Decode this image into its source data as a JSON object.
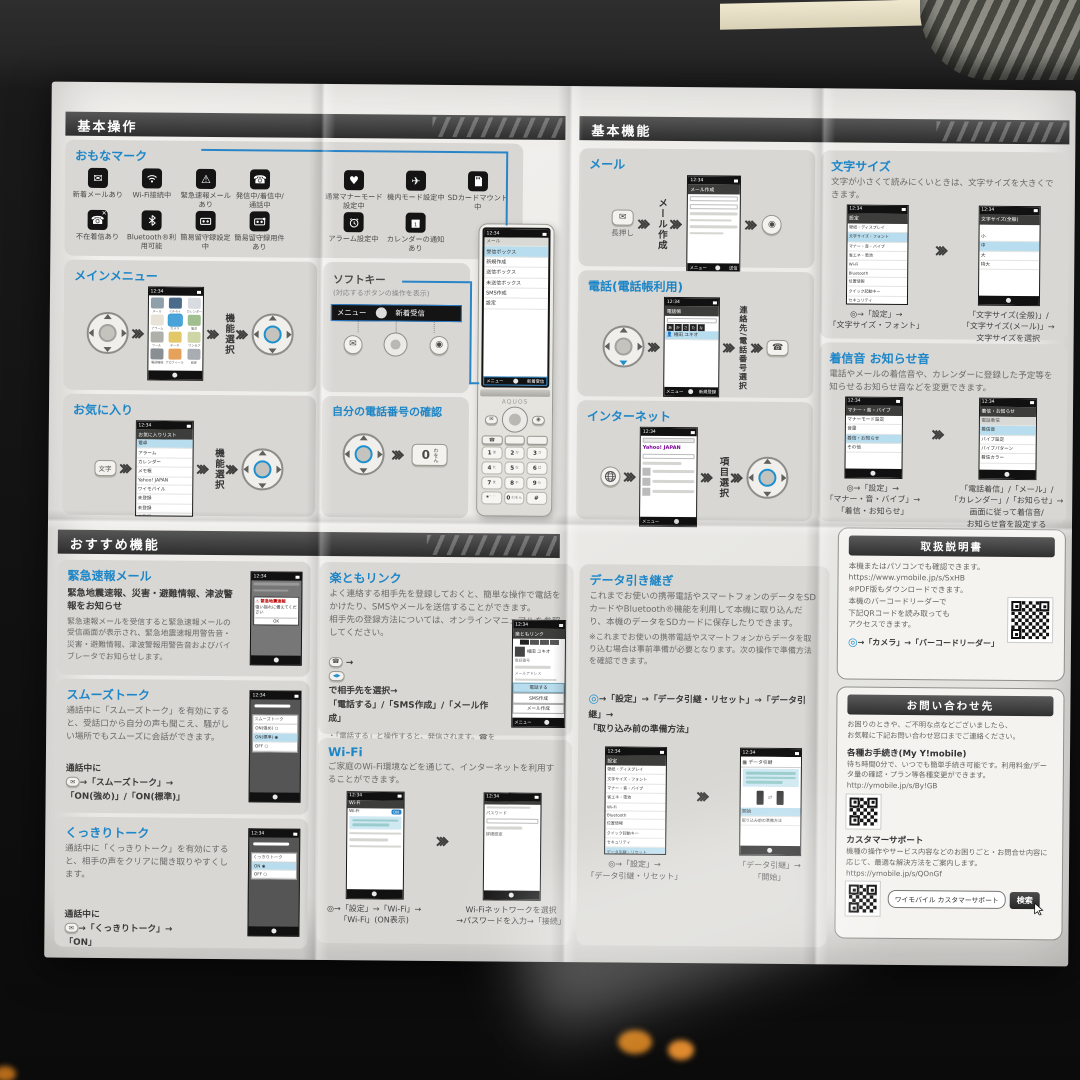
{
  "headers": {
    "h1": "基本操作",
    "h2": "基本機能",
    "h3": "おすすめ機能"
  },
  "status_time": "12:34",
  "marks": {
    "title": "おもなマーク",
    "r1": [
      "新着メールあり",
      "Wi-Fi接続中",
      "緊急速報メールあり",
      "発信中/着信中/通話中",
      "通常マナーモード設定中",
      "機内モード設定中",
      "SDカードマウント中"
    ],
    "r2": [
      "不在着信あり",
      "Bluetooth®利用可能",
      "簡易留守録設定中",
      "簡易留守録用件あり",
      "アラーム設定中",
      "カレンダーの通知あり"
    ]
  },
  "mainmenu": {
    "title": "メインメニュー",
    "step": "機能選択",
    "apps": [
      "メール",
      "ｲﾝﾀｰﾈｯﾄ",
      "カレンダー",
      "アラーム",
      "カメラ",
      "電卓",
      "ツール",
      "データ",
      "ワンセグ",
      "電話機能",
      "プロフィール",
      "設定"
    ]
  },
  "softkey": {
    "title": "ソフトキー",
    "note": "(対応するボタンの操作を表示)",
    "menu": "メニュー",
    "center": "●",
    "right": "新着受信"
  },
  "favorites": {
    "title": "お気に入り",
    "key": "文字",
    "step": "機能選択",
    "screen_title": "お気に入りリスト",
    "list": [
      "電卓",
      "アラーム",
      "カレンダー",
      "メモ帳",
      "Yahoo! JAPAN",
      "ワイモバイル",
      "未登録",
      "未登録",
      "未登録"
    ]
  },
  "mynumber": {
    "title": "自分の電話番号の確認",
    "key_main": "0",
    "key_sub": "わをん"
  },
  "phone": {
    "brand": "AQUOS",
    "screen_title": "メール",
    "menu": [
      "受信ボックス",
      "新規作成",
      "送信ボックス",
      "未送信ボックス",
      "SMS作成",
      "設定"
    ],
    "soft_l": "メニュー",
    "soft_c": "●",
    "soft_r": "新着受信",
    "keys": [
      [
        "1",
        "あ"
      ],
      [
        "2",
        "か"
      ],
      [
        "3",
        "さ"
      ],
      [
        "4",
        "た"
      ],
      [
        "5",
        "な"
      ],
      [
        "6",
        "は"
      ],
      [
        "7",
        "ま"
      ],
      [
        "8",
        "や"
      ],
      [
        "9",
        "ら"
      ],
      [
        "*",
        "゛゜"
      ],
      [
        "0",
        "わをん"
      ],
      [
        "#",
        ""
      ]
    ]
  },
  "mail": {
    "title": "メール",
    "press": "長押し",
    "step": "メール作成",
    "screen_title": "メール作成",
    "soft": "送信"
  },
  "tel": {
    "title": "電話(電話帳利用)",
    "step": "連絡先/電話番号選択",
    "screen_title": "電話帳",
    "tabs": [
      "あ",
      "か",
      "さ",
      "た",
      "な"
    ],
    "entry": "相田 ユキオ",
    "soft_r": "新規登録"
  },
  "inet": {
    "title": "インターネット",
    "step": "項目選択",
    "logo": "Yahoo! JAPAN"
  },
  "settings_title": "設定",
  "settings_list": [
    "壁紙・ディスプレイ",
    "文字サイズ・フォント",
    "マナー・音・バイブ",
    "省エネ・電池",
    "Wi-Fi",
    "Bluetooth",
    "位置情報",
    "クイック起動キー",
    "セキュリティ",
    "データ引継・リセット"
  ],
  "fontsize": {
    "title": "文字サイズ",
    "desc": "文字が小さくて読みにくいときは、文字サイズを大きくできます。",
    "screen2_title": "文字サイズ(全般)",
    "sizes": [
      "小",
      "中",
      "大",
      "特大"
    ],
    "cap1": "◎→「設定」→\n「文字サイズ・フォント」",
    "cap2": "「文字サイズ(全般)」/\n「文字サイズ(メール)」→\n文字サイズを選択"
  },
  "ringtone": {
    "title": "着信音 お知らせ音",
    "desc": "電話やメールの着信音や、カレンダーに登録した予定等を知らせるお知らせ音などを変更できます。",
    "s1_title": "マナー・音・バイブ",
    "s1": [
      "マナーモード設定",
      "音量",
      "着信・お知らせ",
      "その他"
    ],
    "s2_title": "着信・お知らせ",
    "s2": [
      "電話着信",
      "着信音",
      "バイブ設定",
      "バイブパターン",
      "着信カラー"
    ],
    "cap1": "◎→「設定」→\n「マナー・音・バイブ」→\n「着信・お知らせ」",
    "cap2": "「電話着信」/「メール」/\n「カレンダー」/「お知らせ」→\n画面に従って着信音/\nお知らせ音を設定する"
  },
  "emergency": {
    "title": "緊急速報メール",
    "bold": "緊急地震速報、災害・避難情報、津波警報をお知らせ",
    "body": "緊急速報メールを受信すると緊急速報メールの受信画面が表示され、緊急地震速報用警告音・災害・避難情報、津波警報用警告音およびバイブレータでお知らせします。",
    "alert_title": "緊急地震速報",
    "alert_msg": "強い揺れに備えてください",
    "ok": "OK"
  },
  "smooth": {
    "title": "スムーズトーク",
    "body": "通話中に「スムーズトーク」を有効にすると、受話口から自分の声も聞こえ、騒がしい場所でもスムーズに会話ができます。",
    "pre": "通話中に",
    "post": "→「スムーズトーク」→\n「ON(強め)」/「ON(標準)」",
    "dialog": "スムーズトーク",
    "opts": [
      "ON(強め)",
      "ON(標準)",
      "OFF"
    ]
  },
  "clear": {
    "title": "くっきりトーク",
    "body": "通話中に「くっきりトーク」を有効にすると、相手の声をクリアに聞き取りやすくします。",
    "pre": "通話中に",
    "post": "→「くっきりトーク」→\n「ON」",
    "dialog": "くっきりトーク",
    "opts": [
      "ON",
      "OFF"
    ]
  },
  "rakutomo": {
    "title": "楽ともリンク",
    "body": "よく連絡する相手先を登録しておくと、簡単な操作で電話をかけたり、SMSやメールを送信することができます。\n相手先の登録方法については、オンラインマニュアルを参照してください。",
    "post": "で相手先を選択→\n「電話する」/「SMS作成」/「メール作成」",
    "notes": [
      "「電話する」と操作すると、発信されます。☎を押しても発信できます。",
      "「SMS作成」/「メール作成」と操作すると、登録した相手先を宛先にしたSMS/メールの作成画面が表示されます。"
    ],
    "screen_title": "楽ともリンク",
    "entry": "相田 ユキオ",
    "lbl_tel": "電話番号",
    "lbl_mail": "メールアドレス",
    "btns": [
      "電話する",
      "SMS作成",
      "メール作成"
    ]
  },
  "wifi": {
    "title": "Wi-Fi",
    "body": "ご家庭のWi-Fi環境などを通じて、インターネットを利用することができます。",
    "s1_title": "Wi-Fi",
    "on": "ON",
    "pw_label": "パスワード",
    "detail": "詳細設定",
    "cap1": "◎→「設定」→「Wi-Fi」→\n「Wi-Fi」(ON表示)",
    "cap2": "Wi-Fiネットワークを選択\n→パスワードを入力→「接続」"
  },
  "datamove": {
    "title": "データ引き継ぎ",
    "body": "これまでお使いの携帯電話やスマートフォンのデータをSDカードやBluetooth®機能を利用して本機に取り込んだり、本機のデータをSDカードに保存したりできます。",
    "note": "※これまでお使いの携帯電話やスマートフォンからデータを取り込む場合は事前準備が必要となります。次の操作で準備方法を確認できます。",
    "step": "→「設定」→「データ引継・リセット」→「データ引継」→\n「取り込み前の準備方法」",
    "s2_title": "データ引継",
    "start": "開始",
    "prep": "取り込み前の準備方法",
    "cap1": "◎→「設定」→\n「データ引継・リセット」",
    "cap2": "「データ引継」→\n「開始」"
  },
  "manual": {
    "title": "取扱説明書",
    "body1": "本機またはパソコンでも確認できます。\nhttps://www.ymobile.jp/s/SxHB\n※PDF版もダウンロードできます。",
    "body2": "本機のバーコードリーダーで\n下記QRコードを読み取っても\nアクセスできます。",
    "step": "→「カメラ」→「バーコードリーダー」"
  },
  "contact": {
    "title": "お問い合わせ先",
    "intro": "お困りのときや、ご不明な点などございましたら、\nお気軽に下記お問い合わせ窓口までご連絡ください。",
    "s1_title": "各種お手続き(My Y!mobile)",
    "s1_body": "待ち時間0分で、いつでも簡単手続き可能です。利用料金/データ量の確認・プラン等各種変更ができます。\nhttp://ymobile.jp/s/By!GB",
    "s2_title": "カスタマーサポート",
    "s2_body": "機種の操作やサービス内容などのお困りごと・お問合せ内容に応じて、最適な解決方法をご案内します。\nhttps://ymobile.jp/s/QOnGf",
    "search_text": "ワイモバイル カスタマーサポート",
    "search_btn": "検索"
  },
  "icons": {
    "mail": "✉",
    "call": "☎",
    "ok": "◎",
    "camera": "◉",
    "alert": "⚠",
    "heart": "♥",
    "plane": "✈",
    "dpad_lr": "◀▶"
  }
}
